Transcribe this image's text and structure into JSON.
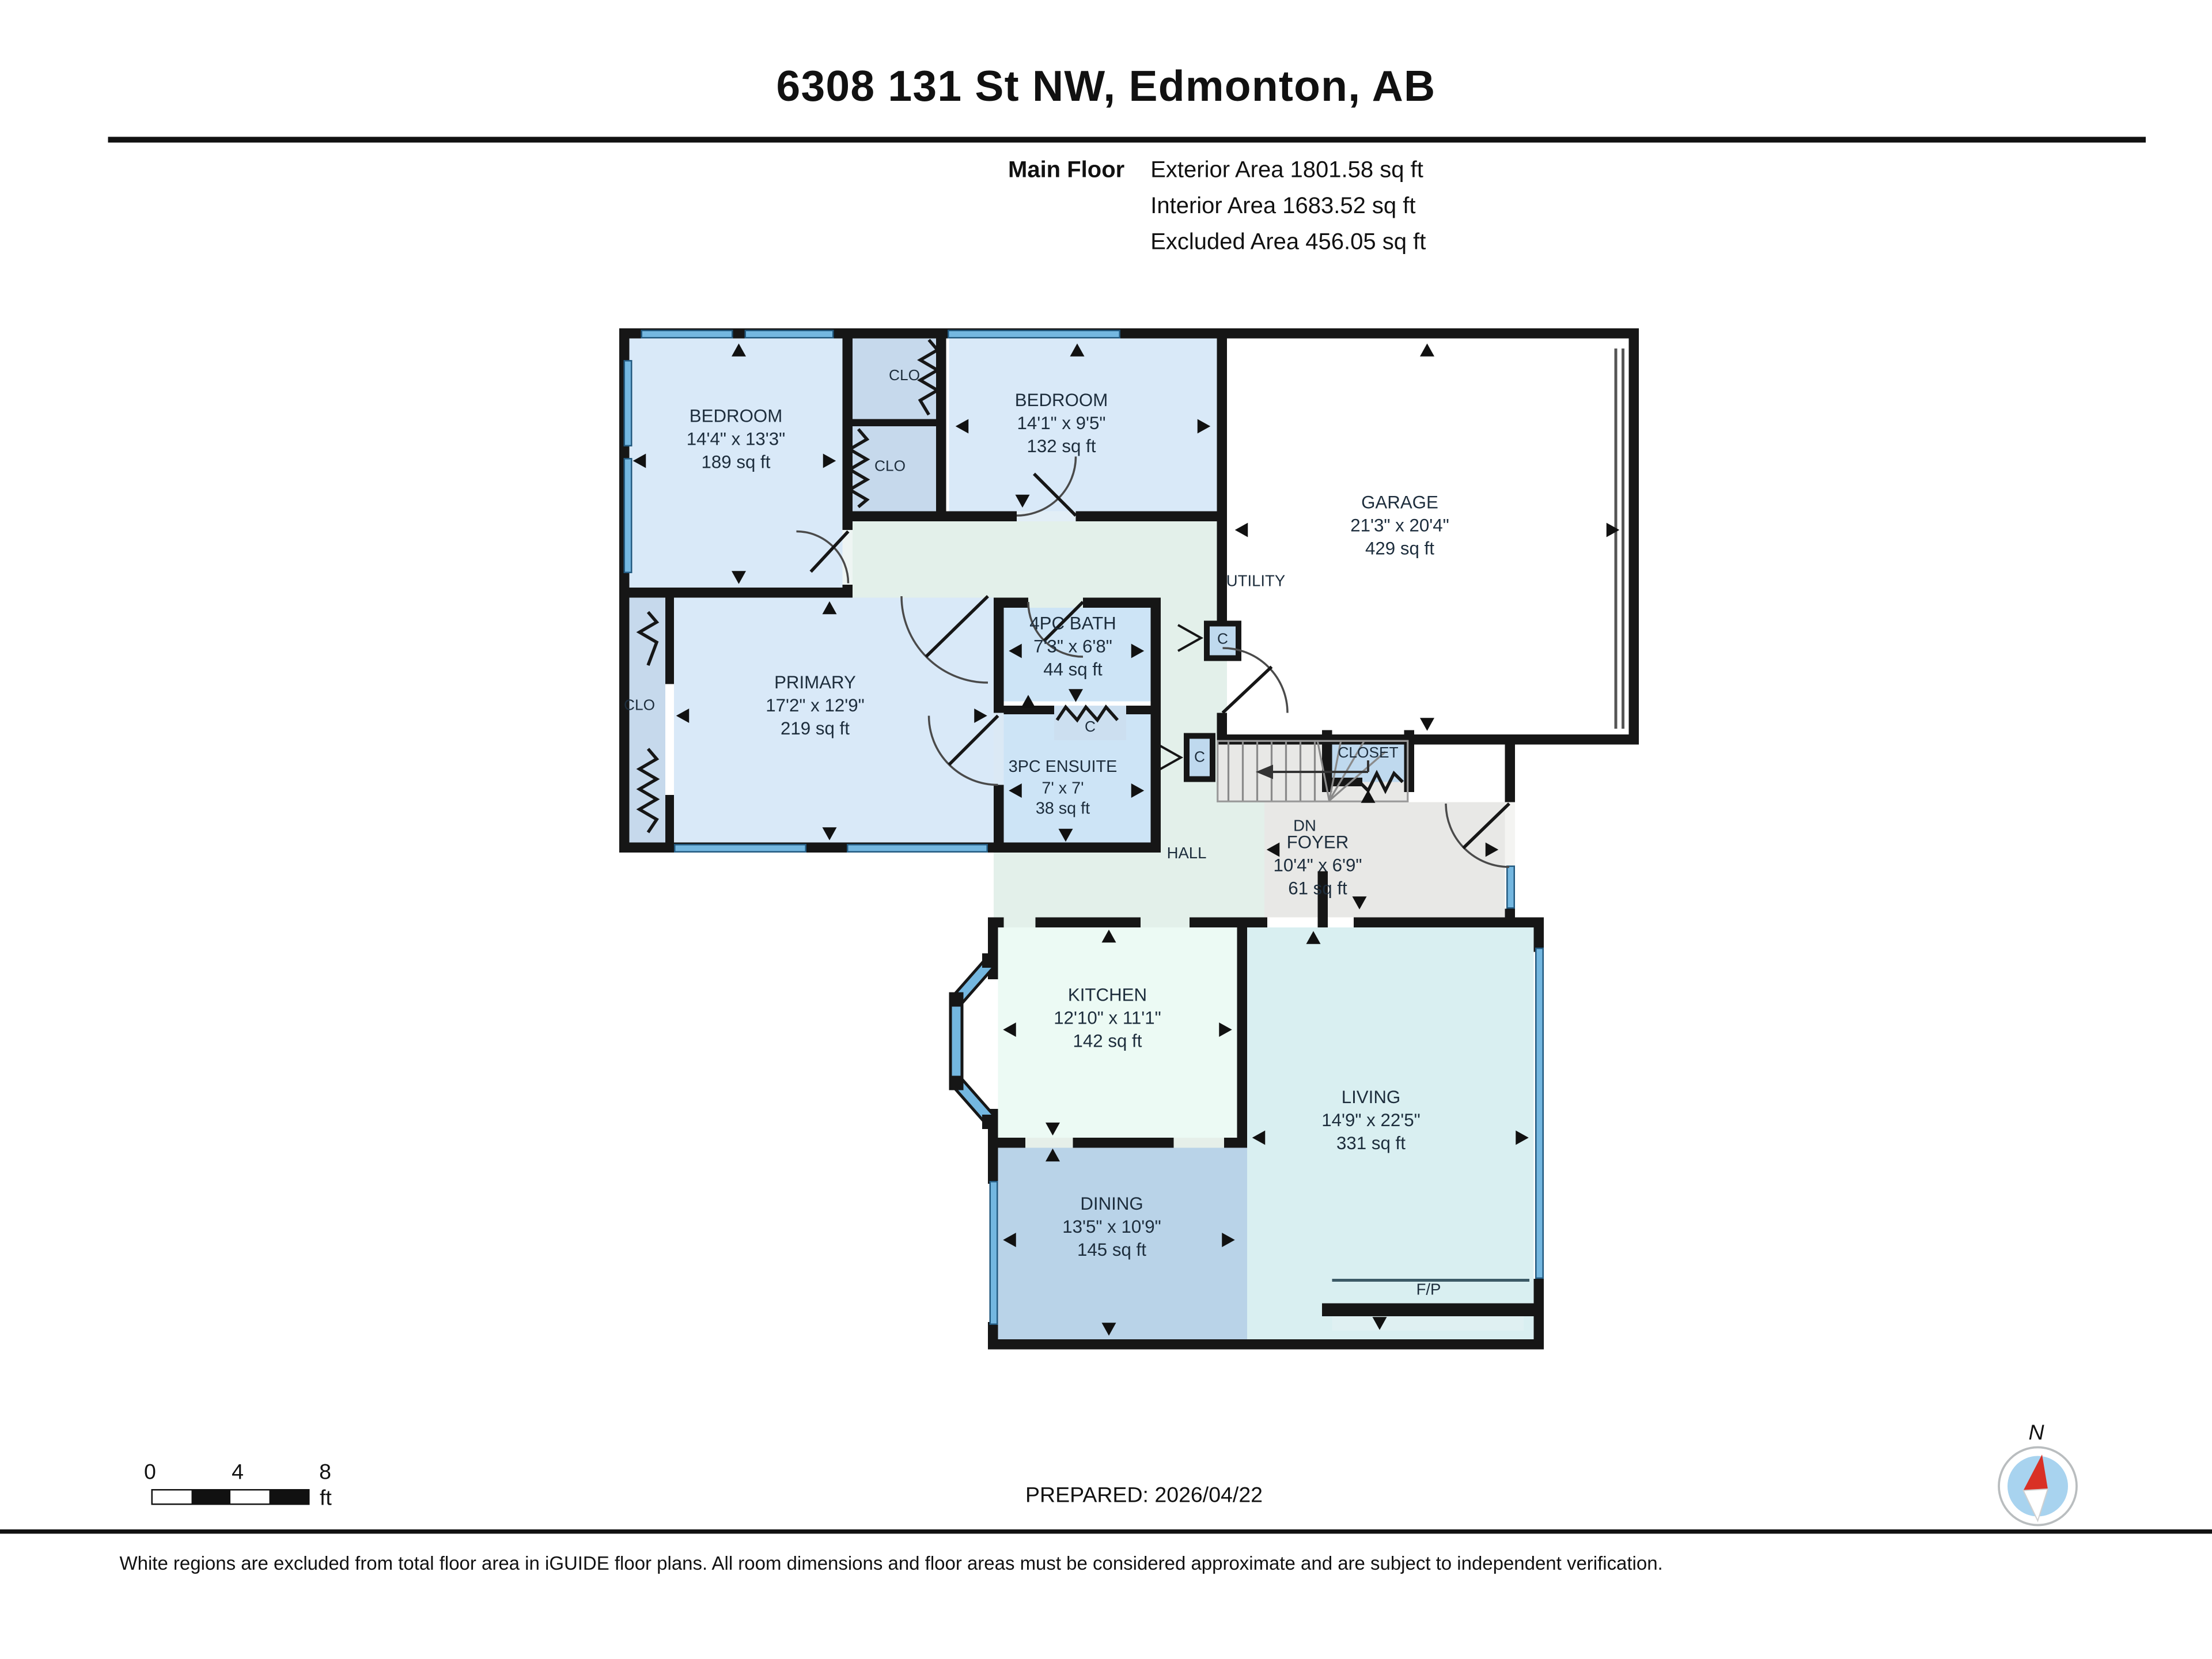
{
  "header": {
    "title": "6308 131 St NW, Edmonton, AB",
    "floor_label": "Main Floor",
    "area_lines": [
      "Exterior Area 1801.58 sq ft",
      "Interior Area 1683.52 sq ft",
      "Excluded Area 456.05 sq ft"
    ]
  },
  "rooms": [
    {
      "id": "bedroom-1",
      "name": "BEDROOM",
      "dim": "14'4\" x 13'3\"",
      "area": "189 sq ft"
    },
    {
      "id": "bedroom-2",
      "name": "BEDROOM",
      "dim": "14'1\" x 9'5\"",
      "area": "132 sq ft"
    },
    {
      "id": "garage",
      "name": "GARAGE",
      "dim": "21'3\" x 20'4\"",
      "area": "429 sq ft"
    },
    {
      "id": "primary",
      "name": "PRIMARY",
      "dim": "17'2\" x 12'9\"",
      "area": "219 sq ft"
    },
    {
      "id": "bath-4pc",
      "name": "4PC BATH",
      "dim": "7'3\" x 6'8\"",
      "area": "44 sq ft"
    },
    {
      "id": "ensuite-3pc",
      "name": "3PC ENSUITE",
      "dim": "7' x 7'",
      "area": "38 sq ft"
    },
    {
      "id": "foyer",
      "name": "FOYER",
      "dim": "10'4\" x 6'9\"",
      "area": "61 sq ft"
    },
    {
      "id": "kitchen",
      "name": "KITCHEN",
      "dim": "12'10\" x 11'1\"",
      "area": "142 sq ft"
    },
    {
      "id": "living",
      "name": "LIVING",
      "dim": "14'9\" x 22'5\"",
      "area": "331 sq ft"
    },
    {
      "id": "dining",
      "name": "DINING",
      "dim": "13'5\" x 10'9\"",
      "area": "145 sq ft"
    }
  ],
  "labels": {
    "clo": "CLO",
    "closet": "CLOSET",
    "utility": "UTILITY",
    "hall": "HALL",
    "dn": "DN",
    "c": "C",
    "fp": "F/P"
  },
  "scale_bar": {
    "ticks": [
      "0",
      "4",
      "8"
    ],
    "unit": "ft"
  },
  "prepared": "PREPARED: 2026/04/22",
  "compass": {
    "label": "N"
  },
  "footer": "White regions are excluded from total floor area in iGUIDE floor plans. All room dimensions and floor areas must be considered approximate and are subject to independent verification.",
  "colors": {
    "wall": "#161616",
    "window": "#74b7e0",
    "room_blue": "#d9e9f8",
    "bath_blue": "#cde4f6",
    "closet_blue": "#c6d9ec",
    "hall_mint": "#e3f0ea",
    "kitchen_mint": "#ecfaf4",
    "living_cyan": "#d9eff1",
    "dining_blue": "#b9d3e8",
    "excluded_gray": "#e8e8e6",
    "compass_red": "#d93025"
  }
}
